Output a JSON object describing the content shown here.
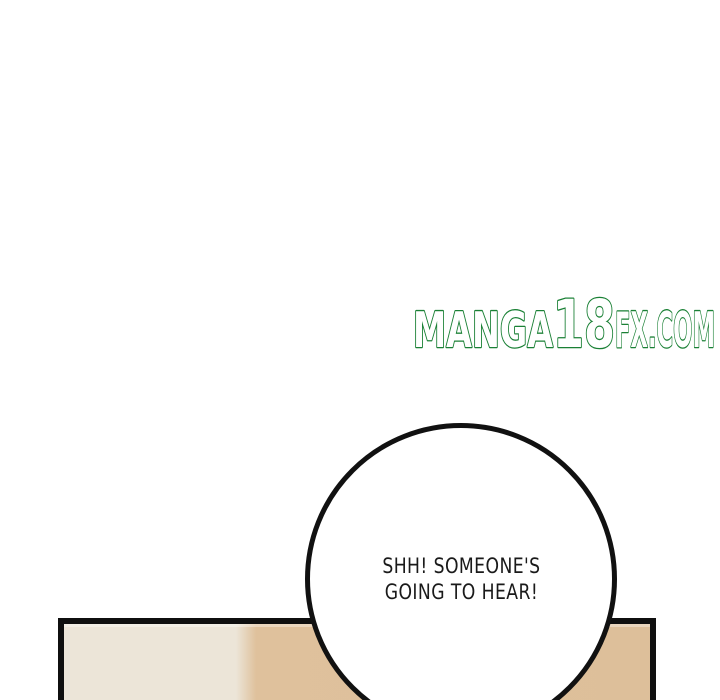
{
  "page": {
    "kind": "manga-page",
    "background_color": "#ffffff"
  },
  "watermark": {
    "full_text": "MANGA18FX.COM",
    "segments": {
      "manga": "MANGA",
      "eighteen": "18",
      "fxcom": "FX.COM"
    },
    "fill_color": "#ffffff",
    "outline_color": "#1a8035"
  },
  "speech_bubble": {
    "lines": {
      "0": "SHH! SOMEONE'S",
      "1": "GOING TO HEAR!"
    },
    "text_color": "#1a1a1a",
    "fill_color": "#ffffff",
    "border_color": "#111111"
  },
  "panel": {
    "border_color": "#0f0f0f",
    "left_wall_color": "#ece5d8",
    "right_wall_color": "#ddbf9a"
  }
}
